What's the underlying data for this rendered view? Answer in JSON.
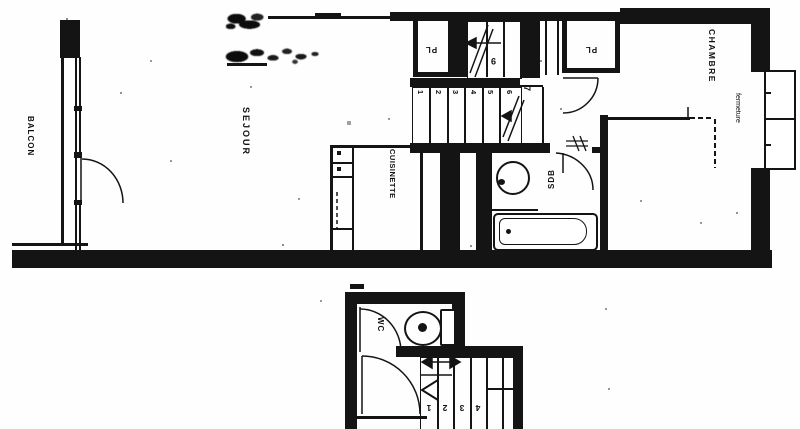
{
  "plan": {
    "type": "floor-plan",
    "upper_level": {
      "balcony_label": "BALCON",
      "living_label": "SEJOUR",
      "kitchen_label": "CUISINETTE",
      "bedroom_label": "CHAMBRE",
      "closure_label": "fermeture",
      "bath_label": "SDB",
      "closet_left_label": "PL",
      "closet_right_label": "PL",
      "stair_step_numbers": [
        "1",
        "2",
        "3",
        "4",
        "5",
        "6"
      ],
      "stair_landing_number": "7",
      "stair_upper_number": "9"
    },
    "lower_level": {
      "wc_label": "WC",
      "stair_step_numbers": [
        "1",
        "2",
        "3",
        "4"
      ]
    }
  }
}
